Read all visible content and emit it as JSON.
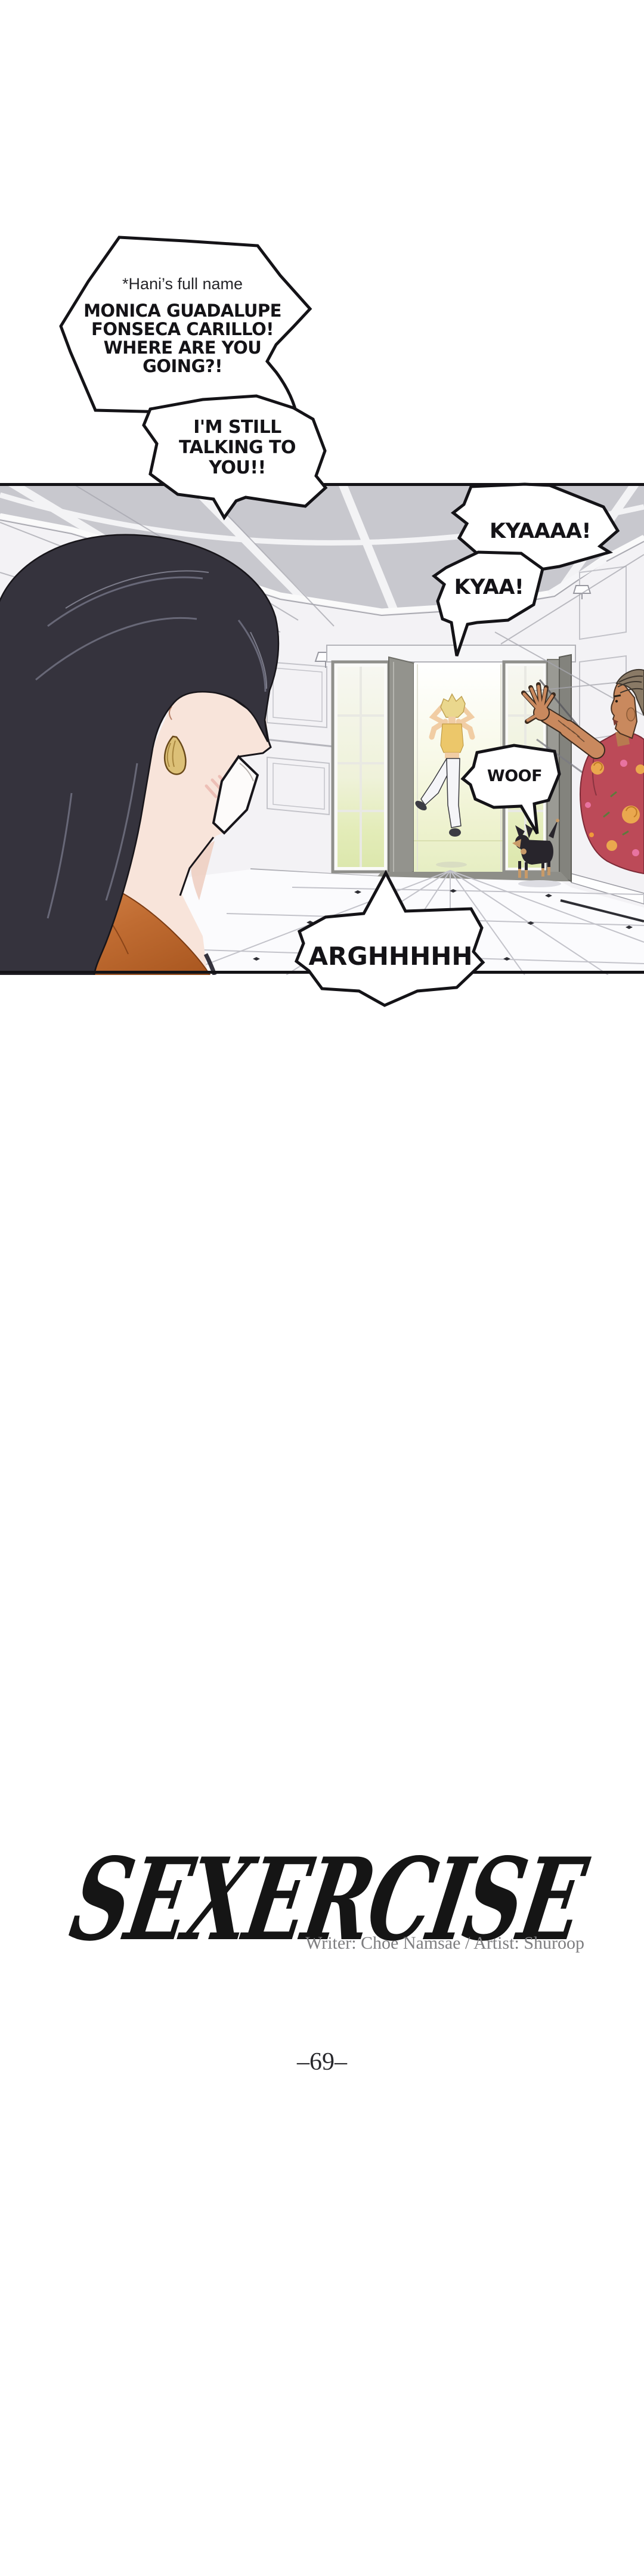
{
  "speech": {
    "hani_note": "*Hani’s full name",
    "monica_call": "MONICA GUADALUPE\nFONSECA CARILLO!\nWHERE ARE YOU\nGOING?!",
    "still_talking": "I'M STILL\nTALKING TO\nYOU!!",
    "kyaaaa": "KYAAAA!",
    "kyaa": "KYAA!",
    "woof": "WOOF",
    "argh": "ARGHHHHH"
  },
  "title_block": {
    "title": "SEXERCISE",
    "credits": "Writer: Choe Namsae / Artist: Shuroop",
    "page_number": "–69–"
  },
  "colors": {
    "paper": "#ffffff",
    "ink": "#141317",
    "ceiling_gray": "#c8c8ce",
    "wall_white": "#f3f2f5",
    "outside_glow": "#e6eec3",
    "woman_hair": "#35333d",
    "woman_shirt_orange": "#c9763f",
    "earring_gold": "#dcc077",
    "girl_hair": "#ead78d",
    "girl_top": "#ecc76a",
    "man_shirt_red": "#bc4a58",
    "dog_black": "#28252c",
    "credits_gray": "#7e7e80"
  }
}
